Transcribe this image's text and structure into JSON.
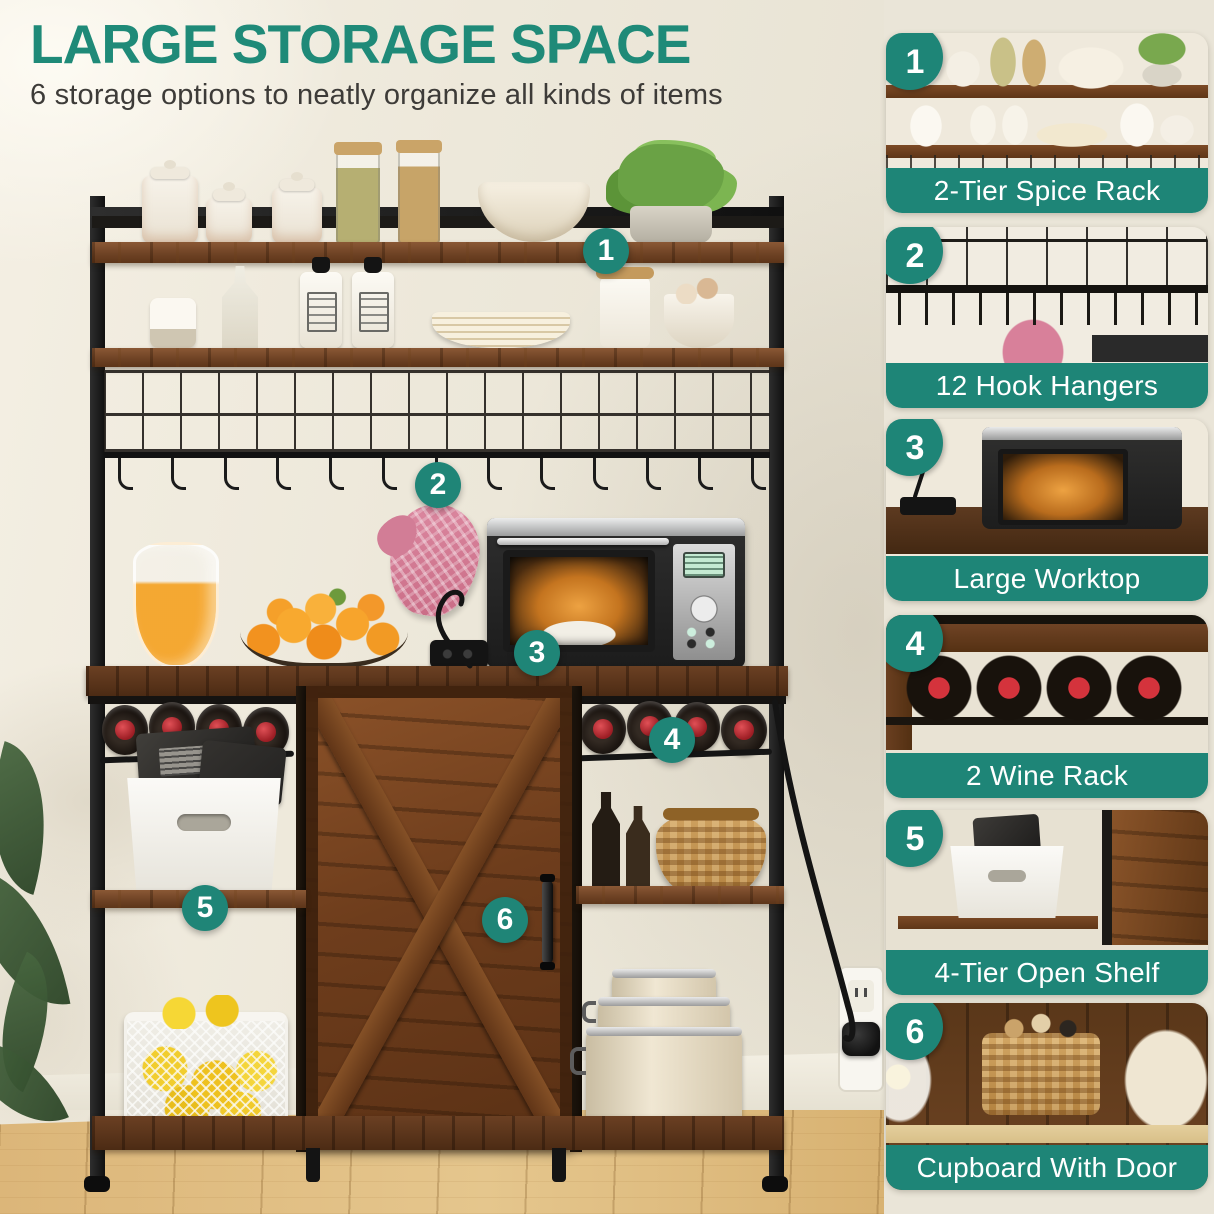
{
  "header": {
    "title": "LARGE STORAGE SPACE",
    "subtitle": "6 storage options to neatly organize all kinds of items"
  },
  "colors": {
    "accent_teal": "#1e8577",
    "title_teal": "#1f8a78",
    "wall_cream": "#ede8da",
    "rustic_wood": "#6f4325",
    "metal_black": "#1a1a1a",
    "floor_wood": "#dcb679"
  },
  "features": [
    {
      "number": "1",
      "label": "2-Tier Spice Rack"
    },
    {
      "number": "2",
      "label": "12 Hook Hangers"
    },
    {
      "number": "3",
      "label": "Large Worktop"
    },
    {
      "number": "4",
      "label": "2 Wine Rack"
    },
    {
      "number": "5",
      "label": "4-Tier Open Shelf"
    },
    {
      "number": "6",
      "label": "Cupboard With Door"
    }
  ]
}
